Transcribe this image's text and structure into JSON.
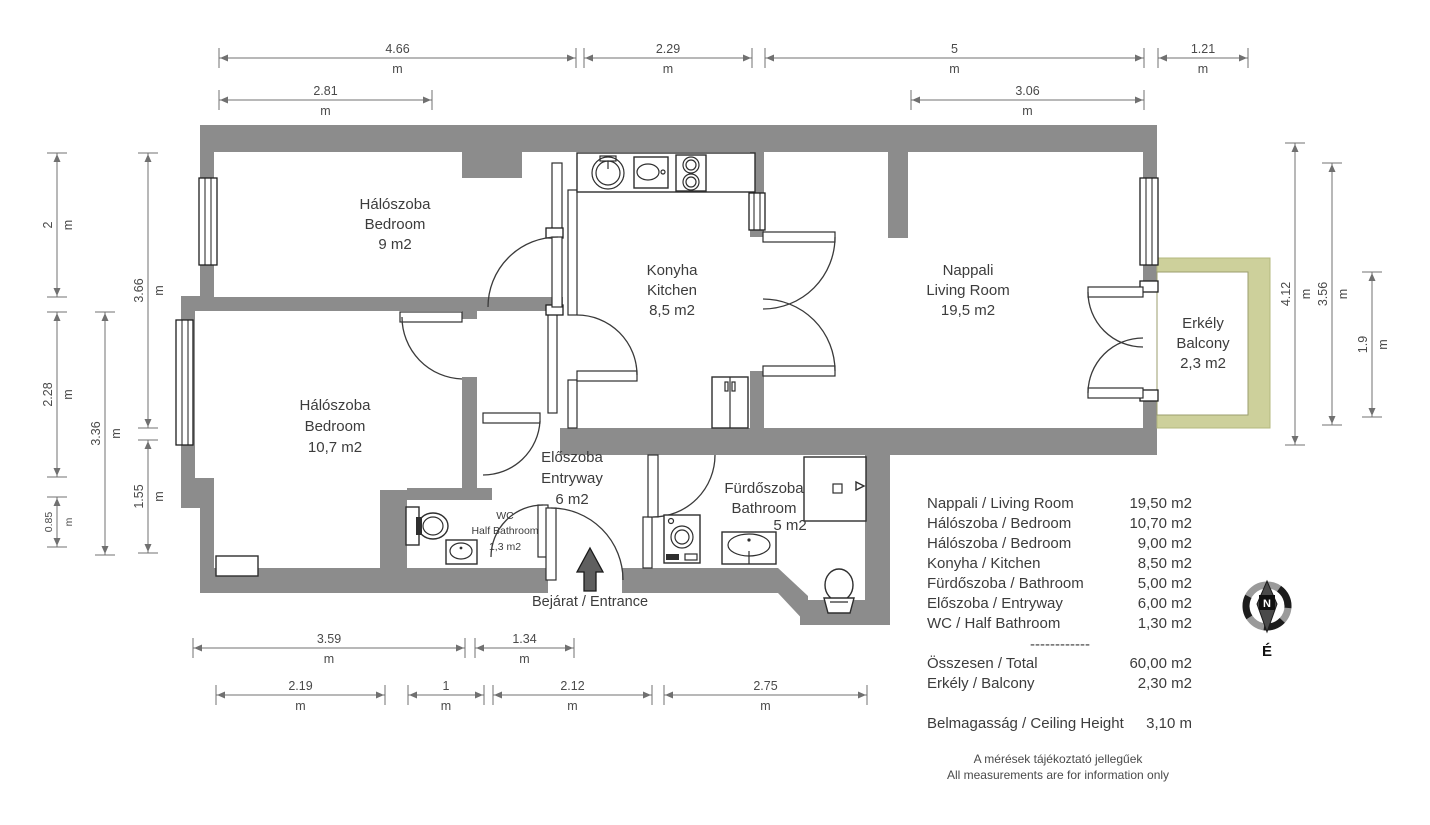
{
  "rooms": [
    {
      "name_hu": "Hálószoba",
      "name_en": "Bedroom",
      "area": "9 m2"
    },
    {
      "name_hu": "Hálószoba",
      "name_en": "Bedroom",
      "area": "10,7 m2"
    },
    {
      "name_hu": "Konyha",
      "name_en": "Kitchen",
      "area": "8,5 m2"
    },
    {
      "name_hu": "Nappali",
      "name_en": "Living Room",
      "area": "19,5 m2"
    },
    {
      "name_hu": "Erkély",
      "name_en": "Balcony",
      "area": "2,3 m2"
    },
    {
      "name_hu": "Előszoba",
      "name_en": "Entryway",
      "area": "6 m2"
    },
    {
      "name_hu": "Fürdőszoba",
      "name_en": "Bathroom",
      "area": "5 m2"
    },
    {
      "name_hu": "WC",
      "name_en": "Half Bathroom",
      "area": "1,3 m2"
    }
  ],
  "entrance_label": "Bejárat / Entrance",
  "compass": {
    "needle_label": "N",
    "north_label": "É"
  },
  "legend": {
    "rows": [
      {
        "label": "Nappali / Living Room",
        "value": "19,50 m2"
      },
      {
        "label": "Hálószoba / Bedroom",
        "value": "10,70 m2"
      },
      {
        "label": "Hálószoba / Bedroom",
        "value": "9,00 m2"
      },
      {
        "label": "Konyha / Kitchen",
        "value": "8,50 m2"
      },
      {
        "label": "Fürdőszoba / Bathroom",
        "value": "5,00 m2"
      },
      {
        "label": "Előszoba / Entryway",
        "value": "6,00 m2"
      },
      {
        "label": "WC / Half Bathroom",
        "value": "1,30 m2"
      }
    ],
    "divider": "------------",
    "total": {
      "label": "Összesen / Total",
      "value": "60,00 m2"
    },
    "balcony": {
      "label": "Erkély / Balcony",
      "value": "2,30 m2"
    },
    "ceiling": {
      "label": "Belmagasság / Ceiling Height",
      "value": "3,10 m"
    }
  },
  "footer": {
    "line1": "A mérések tájékoztató jellegűek",
    "line2": "All measurements are for information only"
  },
  "dims": [
    {
      "value": "4.66",
      "unit": "m"
    },
    {
      "value": "2.29",
      "unit": "m"
    },
    {
      "value": "5",
      "unit": "m"
    },
    {
      "value": "1.21",
      "unit": "m"
    },
    {
      "value": "2.81",
      "unit": "m"
    },
    {
      "value": "3.06",
      "unit": "m"
    },
    {
      "value": "2",
      "unit": "m"
    },
    {
      "value": "2.28",
      "unit": "m"
    },
    {
      "value": "0.85",
      "unit": "m"
    },
    {
      "value": "3.36",
      "unit": "m"
    },
    {
      "value": "3.66",
      "unit": "m"
    },
    {
      "value": "1.55",
      "unit": "m"
    },
    {
      "value": "4.12",
      "unit": "m"
    },
    {
      "value": "3.56",
      "unit": "m"
    },
    {
      "value": "1.9",
      "unit": "m"
    },
    {
      "value": "3.59",
      "unit": "m"
    },
    {
      "value": "1.34",
      "unit": "m"
    },
    {
      "value": "2.19",
      "unit": "m"
    },
    {
      "value": "1",
      "unit": "m"
    },
    {
      "value": "2.12",
      "unit": "m"
    },
    {
      "value": "2.75",
      "unit": "m"
    }
  ],
  "colors": {
    "wall": "#8c8c8c",
    "balcony": "#cdd09b",
    "dim_line": "#707070",
    "text": "#3c3c3c"
  }
}
